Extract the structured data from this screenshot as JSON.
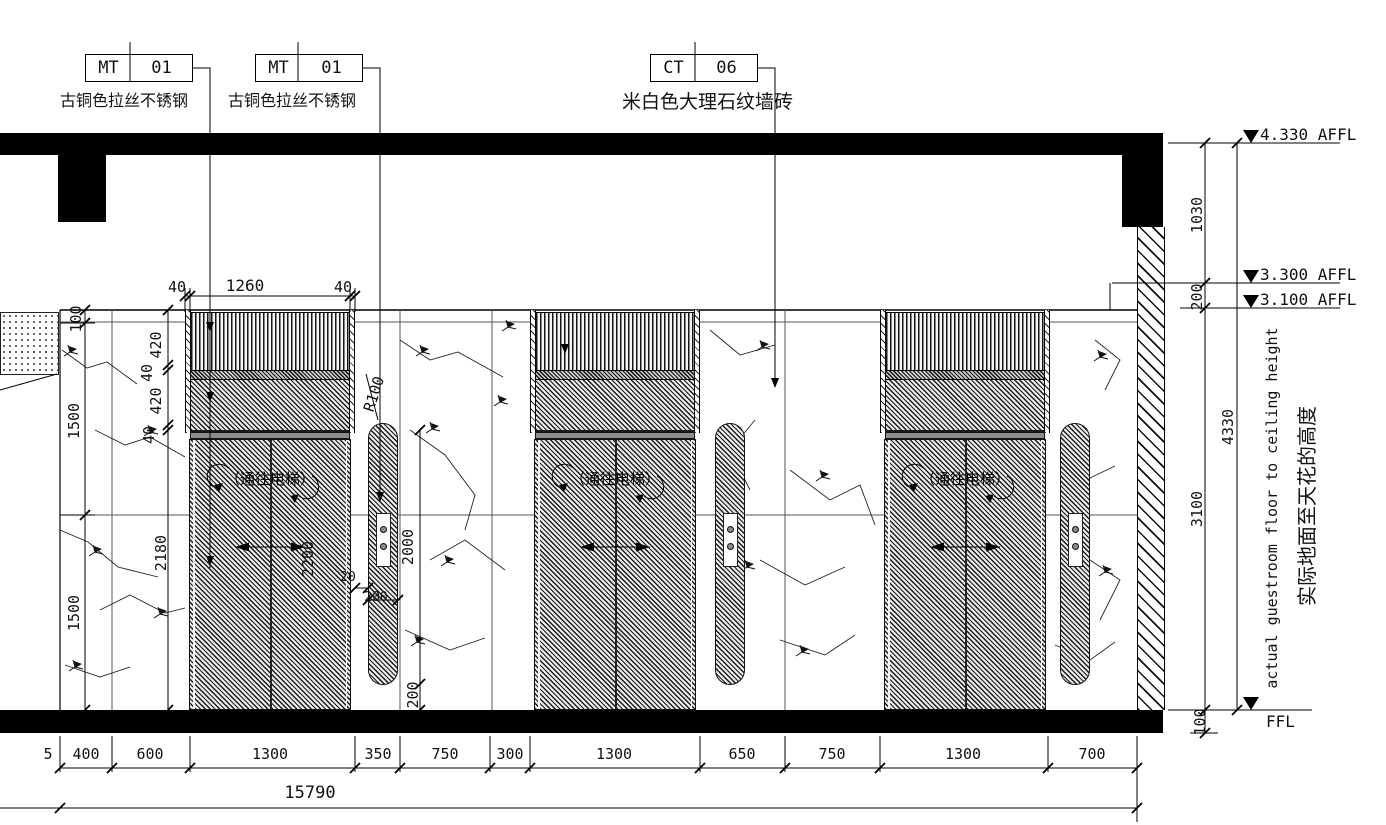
{
  "tags": [
    {
      "code": "MT",
      "number": "01",
      "label": "古铜色拉丝不锈钢"
    },
    {
      "code": "MT",
      "number": "01",
      "label": "古铜色拉丝不锈钢"
    },
    {
      "code": "CT",
      "number": "06",
      "label": "米白色大理石纹墙砖"
    }
  ],
  "levels": {
    "top": "4.330 AFFL",
    "mid_upper": "3.300 AFFL",
    "mid_lower": "3.100 AFFL",
    "floor": "FFL"
  },
  "right_dims": {
    "d1030": "1030",
    "d200": "200",
    "d3100": "3100",
    "d100": "100",
    "d4330": "4330"
  },
  "right_note": {
    "en": "actual guestroom floor to ceiling height",
    "zh": "实际地面至天花的高度"
  },
  "left_dims": {
    "top": "100",
    "mid": "1500",
    "bottom": "1500"
  },
  "door_chain": [
    "420",
    "40",
    "420",
    "40",
    "2180"
  ],
  "top_chain": [
    "40",
    "1260",
    "40"
  ],
  "panel_dims": {
    "height": "2000",
    "bottom_offset": "200",
    "gap": "20",
    "width": "200",
    "radius": "R100",
    "door_height": "2200"
  },
  "door": {
    "label": "（通往电梯）"
  },
  "bottom_chain": {
    "segments": [
      "5",
      "400",
      "600",
      "1300",
      "350",
      "750",
      "300",
      "1300",
      "650",
      "750",
      "1300",
      "700"
    ],
    "total": "15790"
  }
}
